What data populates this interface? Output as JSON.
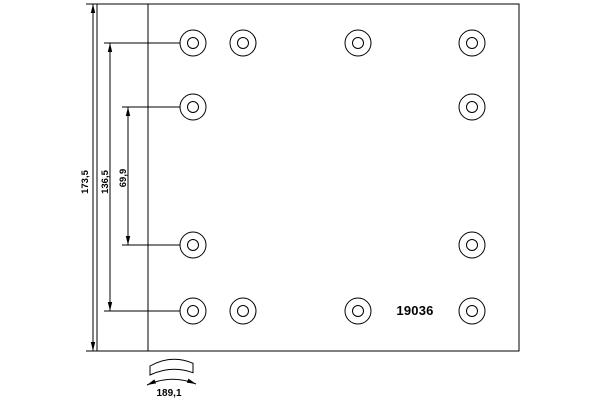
{
  "page": {
    "background": "#ffffff",
    "line_color": "#000000"
  },
  "drawing": {
    "part_number": "19036",
    "dimensions": {
      "overall_height": {
        "label": "173,5"
      },
      "outer_rivet_spacing": {
        "label": "136,5"
      },
      "inner_rivet_spacing": {
        "label": "69,9"
      },
      "arc_width": {
        "label": "189,1"
      }
    },
    "plan_view": {
      "hole_outer_radius": 13,
      "hole_inner_radius": 5.5,
      "hole_rows": [
        {
          "y": 43,
          "x": [
            193,
            243,
            358,
            472
          ]
        },
        {
          "y": 107,
          "x": [
            193,
            472
          ]
        },
        {
          "y": 245,
          "x": [
            193,
            472
          ]
        },
        {
          "y": 311,
          "x": [
            193,
            243,
            358,
            472
          ]
        }
      ]
    }
  }
}
